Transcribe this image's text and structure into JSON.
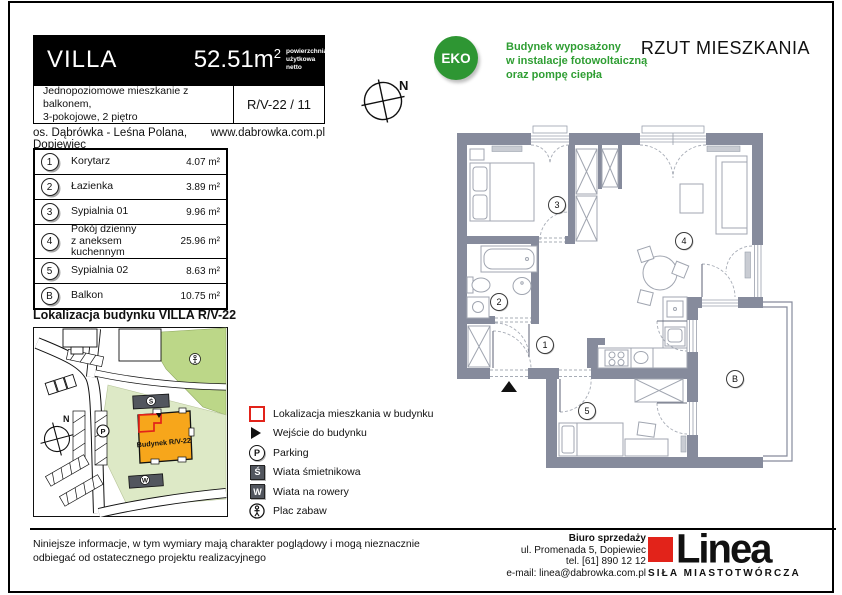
{
  "header": {
    "brand": "VILLA",
    "area_value": "52.51",
    "area_unit": "m",
    "area_sup": "2",
    "area_note": "powierzchnia\nużytkowa\nnetto",
    "description": "Jednopoziomowe mieszkanie z balkonem,\n3-pokojowe, 2 piętro",
    "unit_code": "R/V-22 / 11",
    "estate": "os. Dąbrówka - Leśna Polana, Dopiewiec",
    "website": "www.dabrowka.com.pl"
  },
  "eco": {
    "badge_label": "EKO",
    "text": "Budynek wyposażony\nw instalacje fotowoltaiczną\noraz pompę ciepła"
  },
  "plan_heading": "RZUT MIESZKANIA",
  "compass": {
    "label": "N"
  },
  "rooms": {
    "rows": [
      {
        "num": "1",
        "name": "Korytarz",
        "area": "4.07 m²"
      },
      {
        "num": "2",
        "name": "Łazienka",
        "area": "3.89 m²"
      },
      {
        "num": "3",
        "name": "Sypialnia 01",
        "area": "9.96 m²"
      },
      {
        "num": "4",
        "name": "Pokój dzienny\nz aneksem kuchennym",
        "area": "25.96 m²"
      },
      {
        "num": "5",
        "name": "Sypialnia 02",
        "area": "8.63 m²"
      },
      {
        "num": "B",
        "name": "Balkon",
        "area": "10.75 m²"
      }
    ]
  },
  "location_map": {
    "title": "Lokalizacja budynku  VILLA R/V-22",
    "building_label": "Budynek R/V-22",
    "parking_letter": "P",
    "compass_label": "N"
  },
  "legend": {
    "items": [
      {
        "icon": "apartment-location",
        "label": "Lokalizacja mieszkania w budynku"
      },
      {
        "icon": "building-entrance",
        "label": "Wejście do budynku"
      },
      {
        "icon": "parking",
        "letter": "P",
        "label": "Parking"
      },
      {
        "icon": "trash-shelter",
        "letter": "Ś",
        "label": "Wiata śmietnikowa"
      },
      {
        "icon": "bike-shelter",
        "letter": "W",
        "label": "Wiata na rowery"
      },
      {
        "icon": "playground",
        "label": "Plac zabaw"
      }
    ]
  },
  "plan": {
    "labels": [
      {
        "num": "1"
      },
      {
        "num": "2"
      },
      {
        "num": "3"
      },
      {
        "num": "4"
      },
      {
        "num": "5"
      },
      {
        "num": "B"
      }
    ]
  },
  "footer": {
    "disclaimer": "Niniejsze informacje, w tym wymiary mają charakter poglądowy i mogą nieznacznie\nodbiegać od ostatecznego projektu realizacyjnego",
    "office": {
      "line1": "Biuro sprzedaży",
      "line2": "ul. Promenada 5, Dopiewiec",
      "line3": "tel. [61] 890 12 12",
      "line4": "e-mail: linea@dabrowka.com.pl"
    },
    "logo": {
      "name": "Linea",
      "tagline": "SIŁA MIASTOTWÓRCZA"
    }
  },
  "colors": {
    "eco_green": "#2e9633",
    "text_green": "#2f9e33",
    "wall_gray": "#868b9c",
    "accent_orange": "#f7a61b",
    "brand_red": "#e2231a",
    "map_green_dark": "#bcd788",
    "map_green_light": "#dde9c6"
  }
}
